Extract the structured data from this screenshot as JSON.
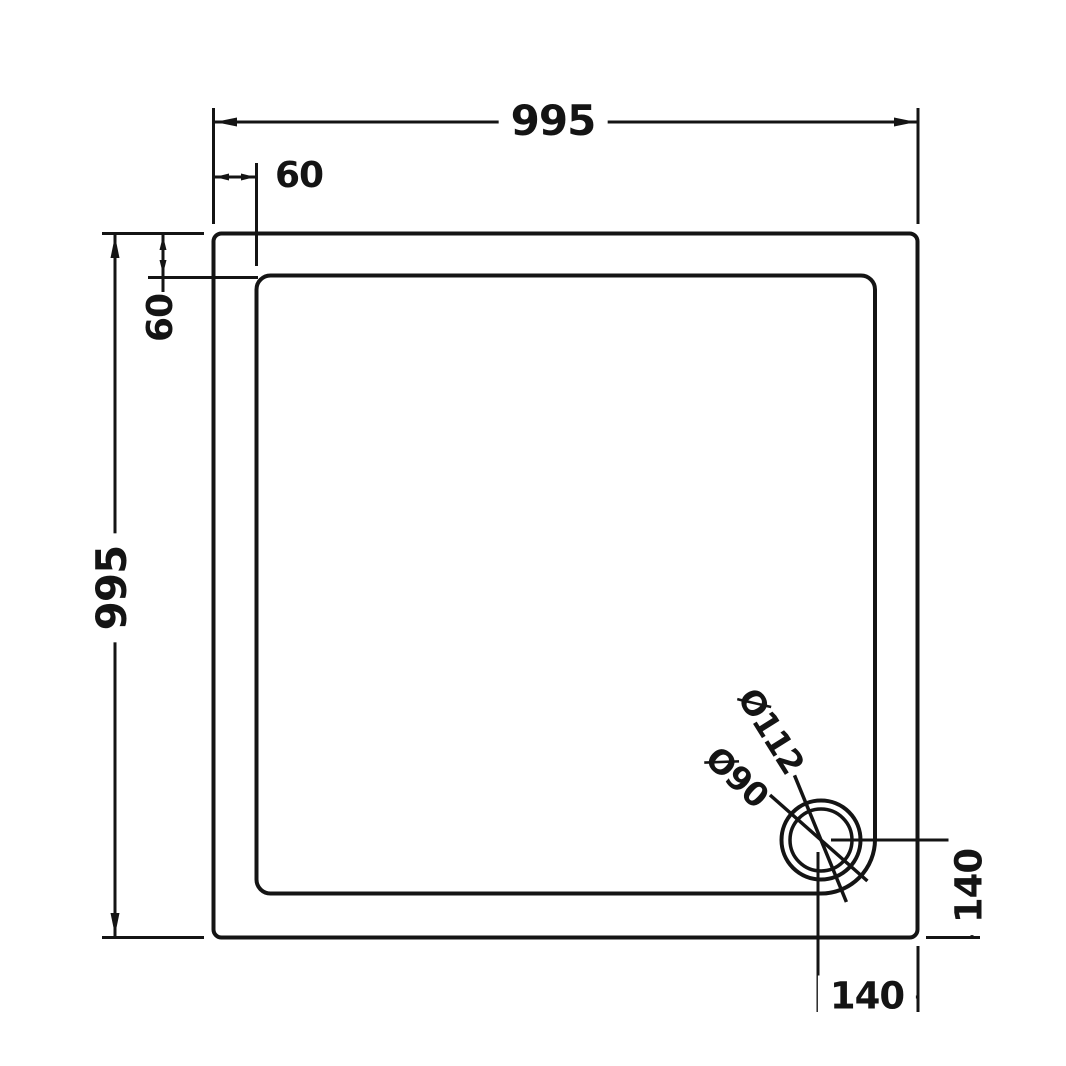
{
  "drawing": {
    "title": "square-shower-tray-dimension-diagram",
    "background_color": "#ffffff",
    "line_color": "#141414",
    "dimensions": {
      "overall_width_top": {
        "label": "995"
      },
      "rim_thickness_top": {
        "label": "60"
      },
      "rim_thickness_left": {
        "label": "60"
      },
      "overall_height_left": {
        "label": "995"
      },
      "drain_outer_diameter": {
        "label": "Ø112"
      },
      "drain_inner_diameter": {
        "label": "Ø90"
      },
      "drain_offset_from_bottom": {
        "label": "140"
      },
      "drain_offset_from_right": {
        "label": "140"
      }
    }
  }
}
